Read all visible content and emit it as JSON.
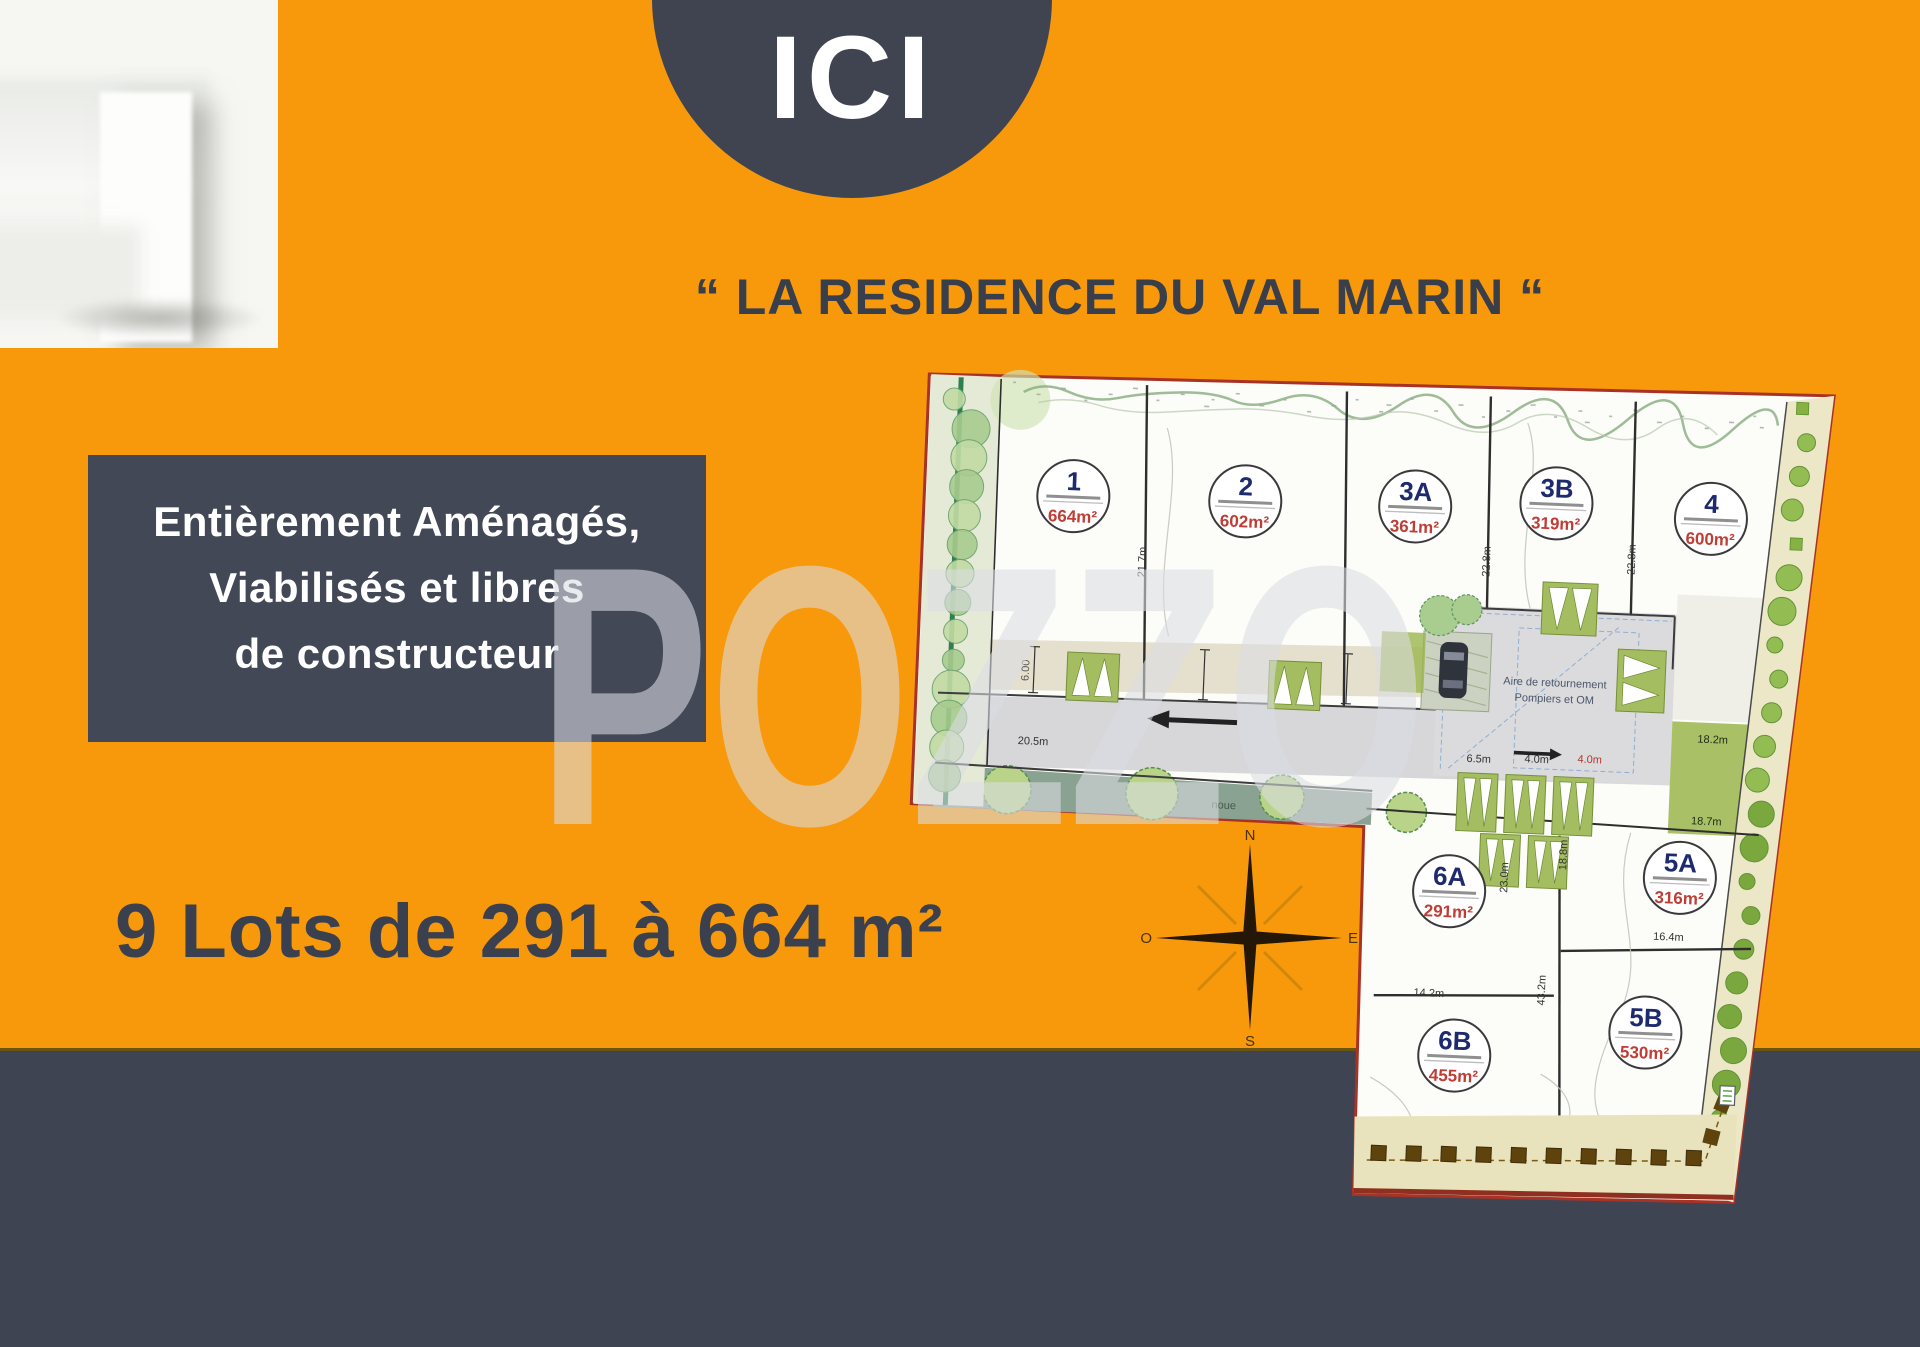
{
  "banner": {
    "ici": "ICI"
  },
  "title": "“ LA RESIDENCE DU VAL MARIN “",
  "features": {
    "line1": "Entièrement Aménagés,",
    "line2": "Viabilisés et libres",
    "line3": "de constructeur"
  },
  "headline": "9 Lots de 291 à 664 m²",
  "watermark": "POZZO",
  "compass": {
    "north": "N",
    "east": "E",
    "south": "S",
    "west": "O"
  },
  "plan": {
    "lots": [
      {
        "id": "1",
        "area": "664m²"
      },
      {
        "id": "2",
        "area": "602m²"
      },
      {
        "id": "3A",
        "area": "361m²"
      },
      {
        "id": "3B",
        "area": "319m²"
      },
      {
        "id": "4",
        "area": "600m²"
      },
      {
        "id": "6A",
        "area": "291m²"
      },
      {
        "id": "5A",
        "area": "316m²"
      },
      {
        "id": "6B",
        "area": "455m²"
      },
      {
        "id": "5B",
        "area": "530m²"
      }
    ],
    "labels": {
      "turning_area_1": "Aire de retournement",
      "turning_area_2": "Pompiers et OM",
      "swale": "noue"
    },
    "measurements": [
      {
        "id": "m1",
        "text": "21.7m"
      },
      {
        "id": "m2",
        "text": "22.8m"
      },
      {
        "id": "m3",
        "text": "22.8m"
      },
      {
        "id": "m4",
        "text": "20.5m"
      },
      {
        "id": "m5",
        "text": "6.5m"
      },
      {
        "id": "m6",
        "text": "4.0m"
      },
      {
        "id": "m7",
        "text": "4.0m"
      },
      {
        "id": "m8",
        "text": "18.2m"
      },
      {
        "id": "m9",
        "text": "18.7m"
      },
      {
        "id": "m10",
        "text": "23.0m"
      },
      {
        "id": "m11",
        "text": "18.8m"
      },
      {
        "id": "m12",
        "text": "43.2m"
      },
      {
        "id": "m13",
        "text": "14.2m"
      },
      {
        "id": "m14",
        "text": "16.4m"
      },
      {
        "id": "m15",
        "text": "6.00"
      }
    ]
  },
  "colors": {
    "orange": "#F7990B",
    "dark": "#414654",
    "plan_border": "#A93226",
    "lot_number": "#1D2B6E",
    "lot_area": "#BF3D34"
  }
}
